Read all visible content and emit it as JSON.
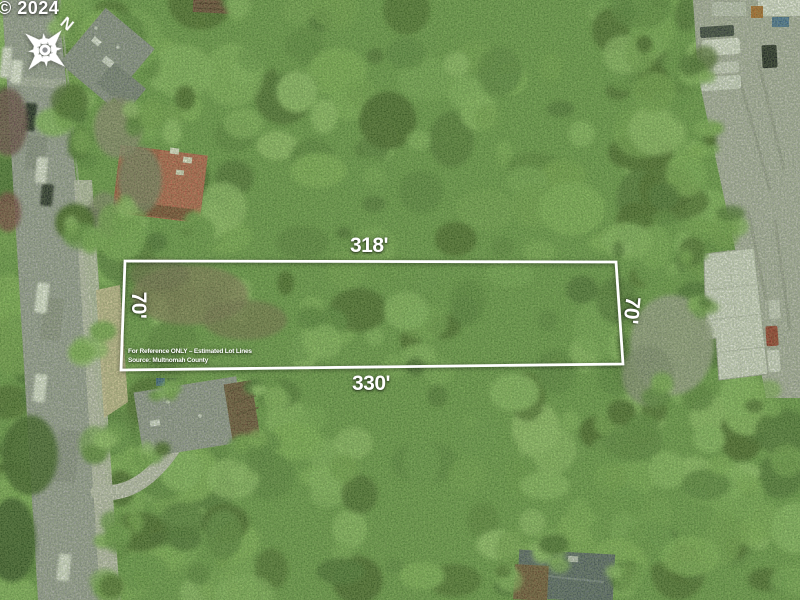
{
  "photo": {
    "copyright": "© 2024",
    "compass": {
      "north_label": "N"
    }
  },
  "lot_overlay": {
    "dimensions": {
      "top": "318'",
      "bottom": "330'",
      "left": "70'",
      "right": "70'"
    },
    "disclaimer": "For Reference ONLY – Estimated Lot Lines",
    "source": "Source: Multnomah County",
    "line_color": "#ffffff"
  },
  "scene_colors": {
    "canopy_green": "#6b9a4d",
    "road_gray": "#9fa1a2",
    "pavement_gray": "#b2b3af",
    "warehouse_roof": "#dcded9"
  }
}
